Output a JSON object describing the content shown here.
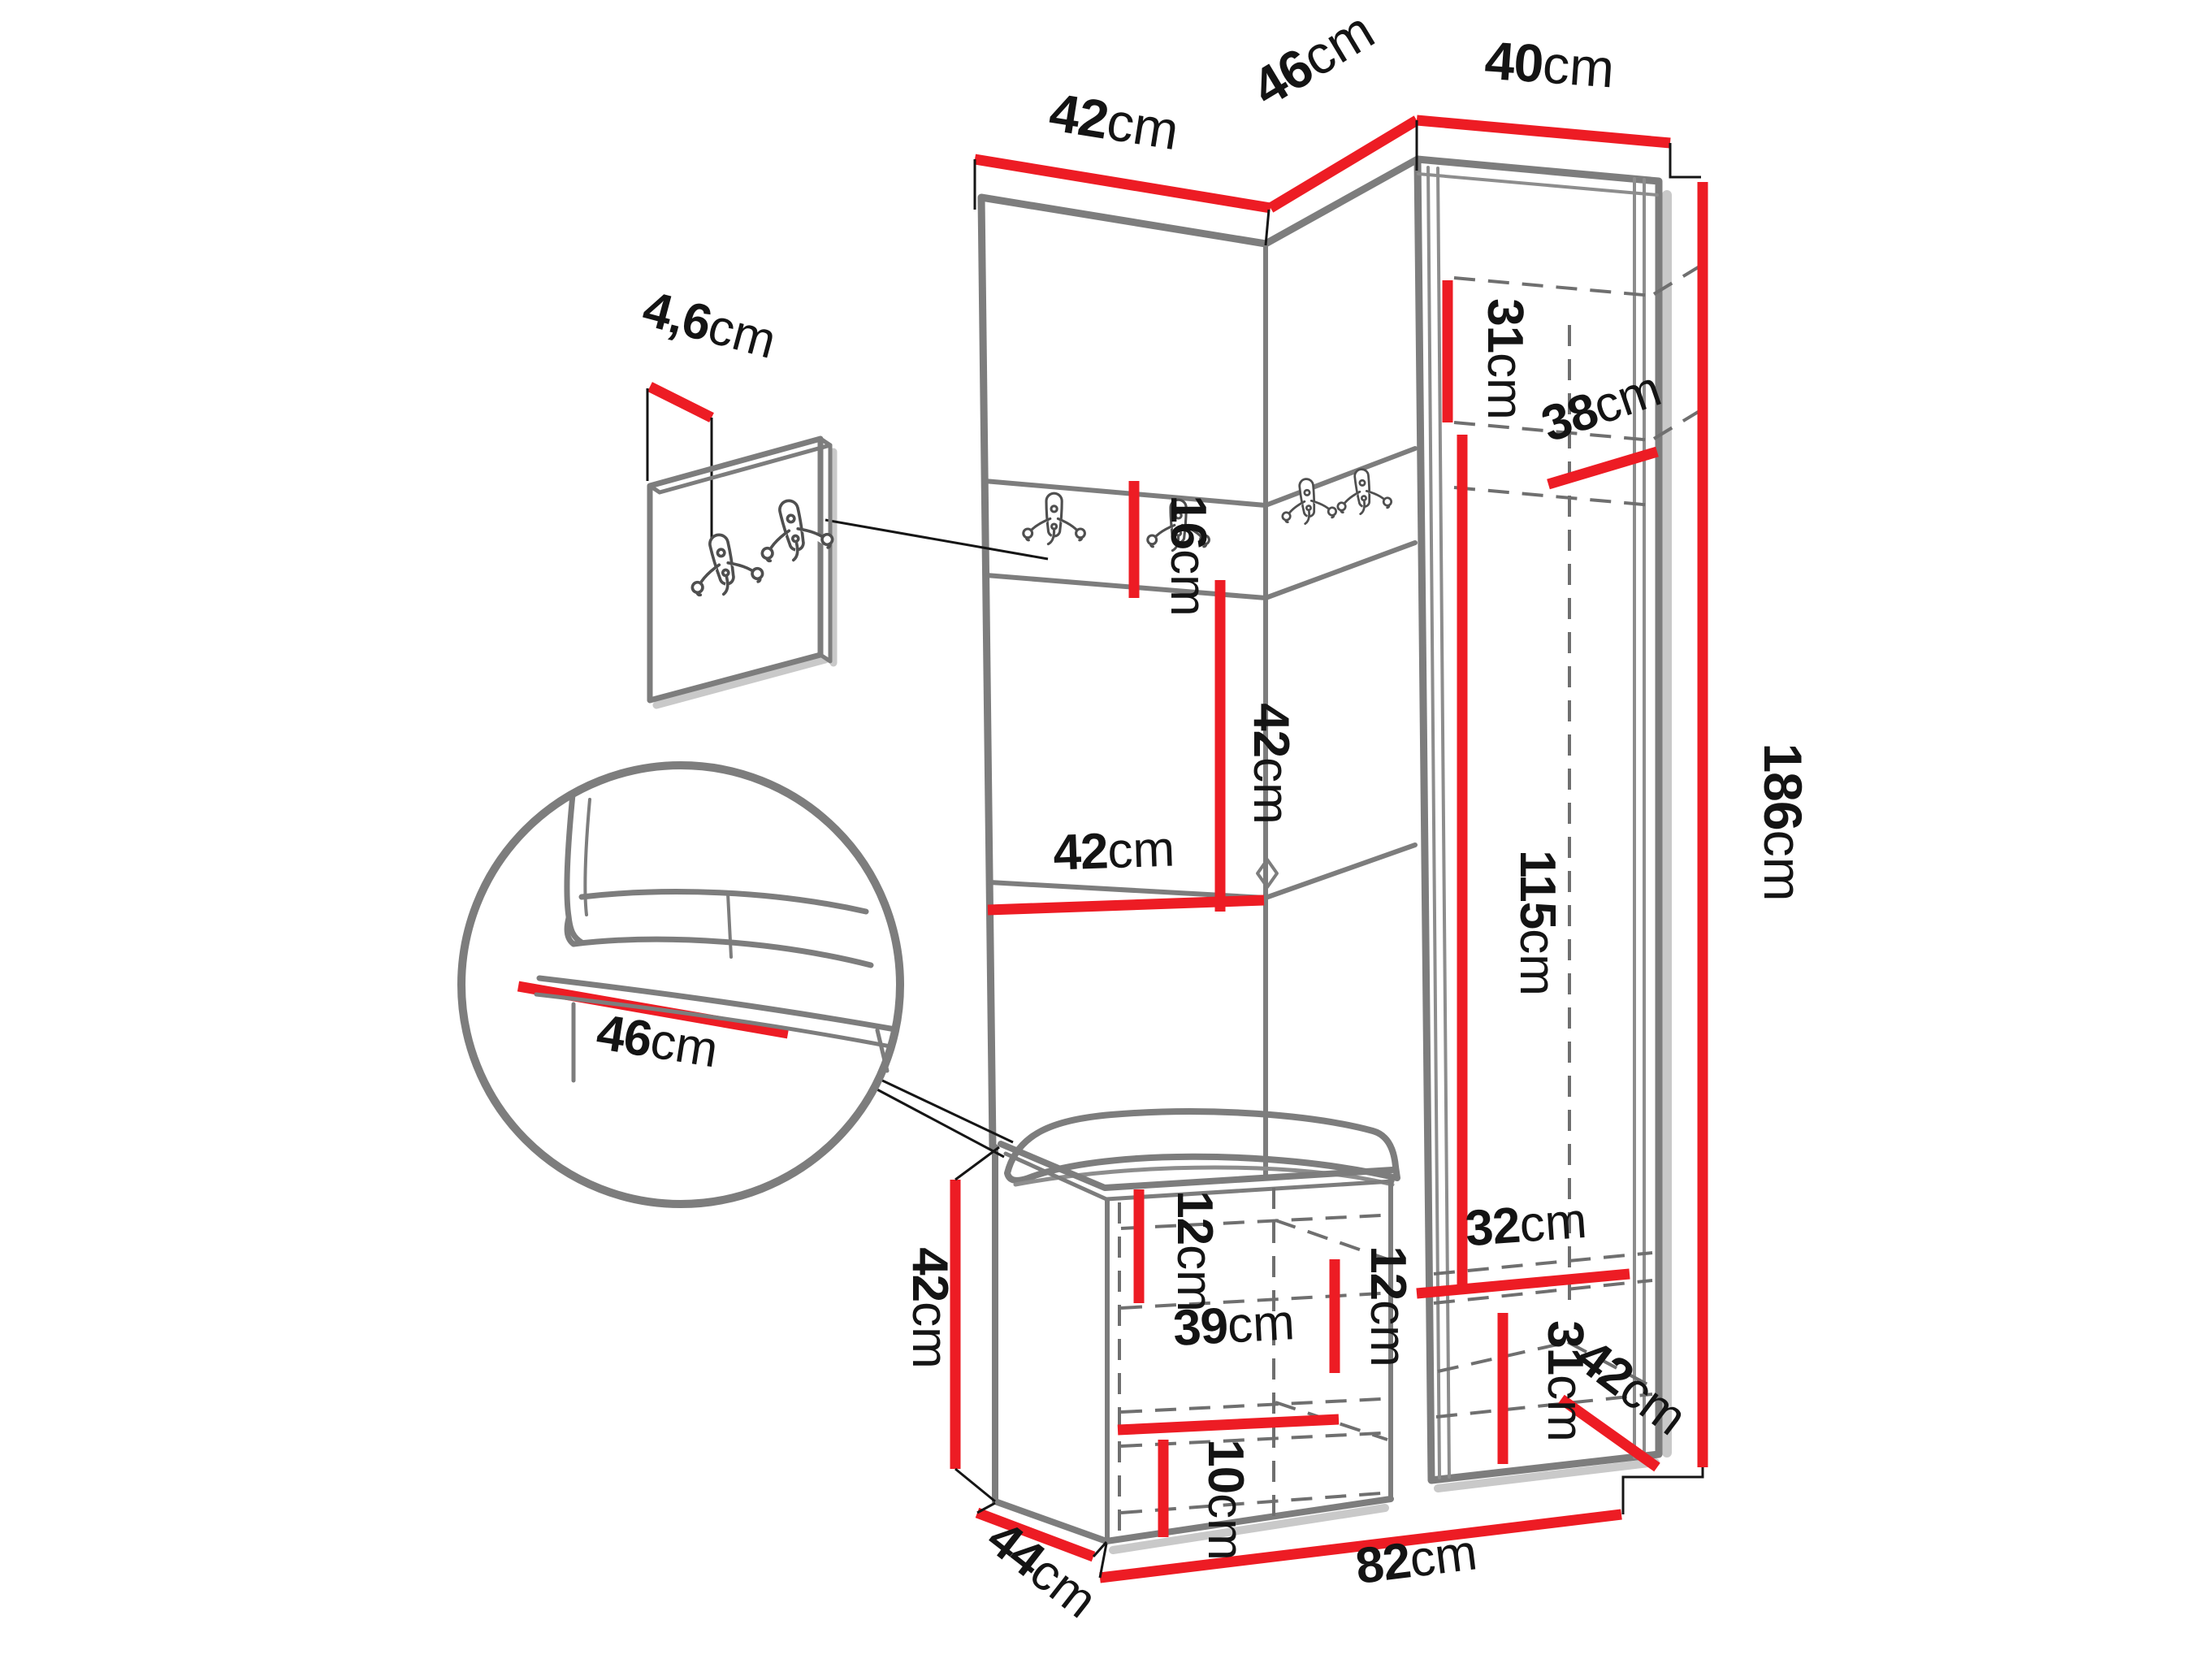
{
  "diagram": {
    "kind": "hallway-furniture-dimension-drawing",
    "background": "#ffffff",
    "accent_color": "#ed1c24",
    "outline_color": "#7d7d7d",
    "dashed_color": "#6f6f6f",
    "leader_color": "#151515",
    "text_color": "#141414",
    "icons": [
      "double-coat-hook-icon"
    ]
  },
  "dimensions": {
    "top_left_width": {
      "num": "42",
      "unit": "cm"
    },
    "top_corner_width": {
      "num": "46",
      "unit": "cm"
    },
    "top_right_width": {
      "num": "40",
      "unit": "cm"
    },
    "total_height": {
      "num": "186",
      "unit": "cm"
    },
    "cab_top_section_height": {
      "num": "31",
      "unit": "cm"
    },
    "cab_top_depth": {
      "num": "38",
      "unit": "cm"
    },
    "cab_inner_height": {
      "num": "115",
      "unit": "cm"
    },
    "cab_bottom_inner_width": {
      "num": "32",
      "unit": "cm"
    },
    "cab_bottom_section_height": {
      "num": "31",
      "unit": "cm"
    },
    "cab_bottom_depth": {
      "num": "42",
      "unit": "cm"
    },
    "hook_strip_height": {
      "num": "16",
      "unit": "cm"
    },
    "back_panel_height": {
      "num": "42",
      "unit": "cm"
    },
    "back_panel_width": {
      "num": "42",
      "unit": "cm"
    },
    "hook_board_thickness": {
      "num": "4,6",
      "unit": "cm"
    },
    "seat_detail_depth": {
      "num": "46",
      "unit": "cm"
    },
    "bench_height": {
      "num": "42",
      "unit": "cm"
    },
    "bench_top_gap": {
      "num": "12",
      "unit": "cm"
    },
    "bench_right_gap": {
      "num": "12",
      "unit": "cm"
    },
    "bench_shelf_width": {
      "num": "39",
      "unit": "cm"
    },
    "bench_bottom_gap": {
      "num": "10",
      "unit": "cm"
    },
    "bench_depth": {
      "num": "44",
      "unit": "cm"
    },
    "base_total_width": {
      "num": "82",
      "unit": "cm"
    }
  }
}
